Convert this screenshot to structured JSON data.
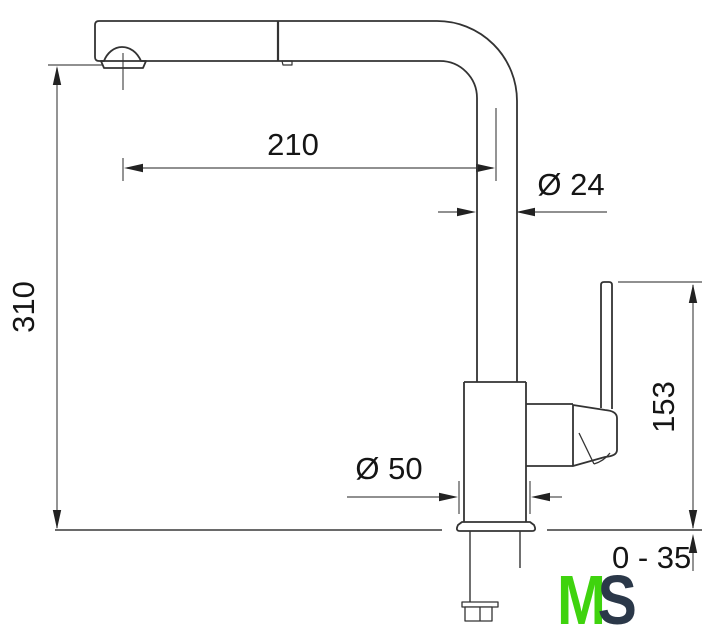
{
  "dimensions": {
    "spout_reach": "210",
    "spout_tube_diameter": "Ø 24",
    "overall_height": "310",
    "handle_top_height": "153",
    "base_diameter": "Ø 50",
    "mounting_thickness_range": "0 - 35"
  },
  "logo": {
    "letter_m": "M",
    "letter_s": "S",
    "m_color": "#3fd30e",
    "s_color": "#2b3849"
  }
}
